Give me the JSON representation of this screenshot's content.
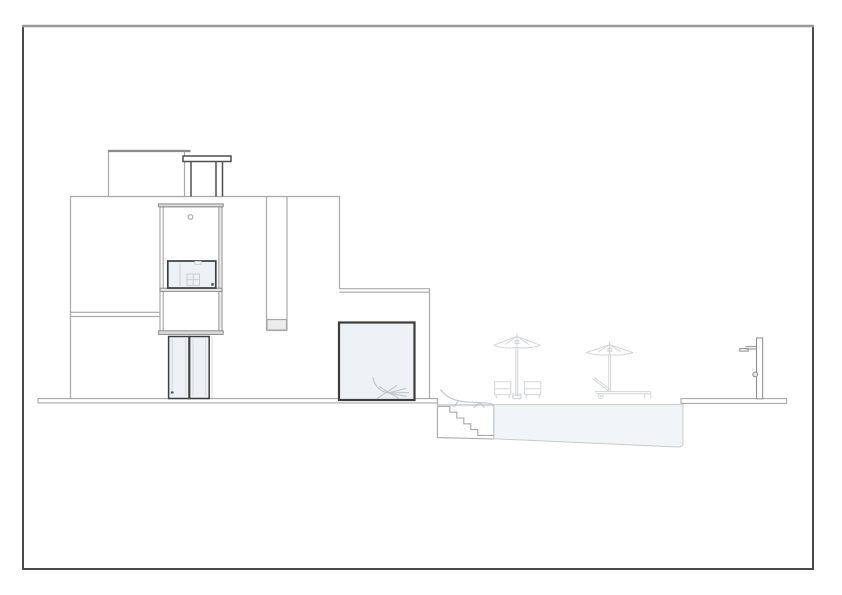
{
  "meta": {
    "canvas_width": 842,
    "canvas_height": 595,
    "drawing_type": "architectural side elevation of a modern flat-roof house with sunken pool terrace"
  },
  "colors": {
    "paper": "#ffffff",
    "frame_border": "#4a4a4a",
    "frame_border_top": "#9a9a9a",
    "wall_line": "#a9a9a9",
    "wall_line_strong": "#8b8b8b",
    "dark_line": "#3d3d3d",
    "pergola_line": "#4f4f4f",
    "faint_line": "#cfd3d6",
    "interior_line": "#c6cbd0",
    "glass_fill": "#edf1f6",
    "water_fill": "#f1f5f8",
    "water_line": "#c6cbcf",
    "furniture_line": "#d3d6d8",
    "chaise_line": "#c0c5c9",
    "cap_fill": "#dcdcdc",
    "shadow_fill": "#ebebeb",
    "sill_fill": "#e8e8e8",
    "accent_dot": "#555555"
  },
  "scene": {
    "objects": [
      "drawing-frame",
      "house-main-block",
      "roof-stair-bulkhead",
      "roof-pergola",
      "facade-tower",
      "tower-upper-window",
      "tower-glass-doors",
      "facade-recess-slot",
      "single-storey-wing",
      "picture-window",
      "ground-slab",
      "sunken-pool",
      "pool-steps",
      "parasol-with-two-chairs",
      "parasol-with-sun-lounger",
      "poolside-chaise",
      "chaise-behind-picture-window",
      "outdoor-shower"
    ],
    "parasol_count": 2,
    "pool_step_count": 6,
    "glass_door_count": 2
  }
}
